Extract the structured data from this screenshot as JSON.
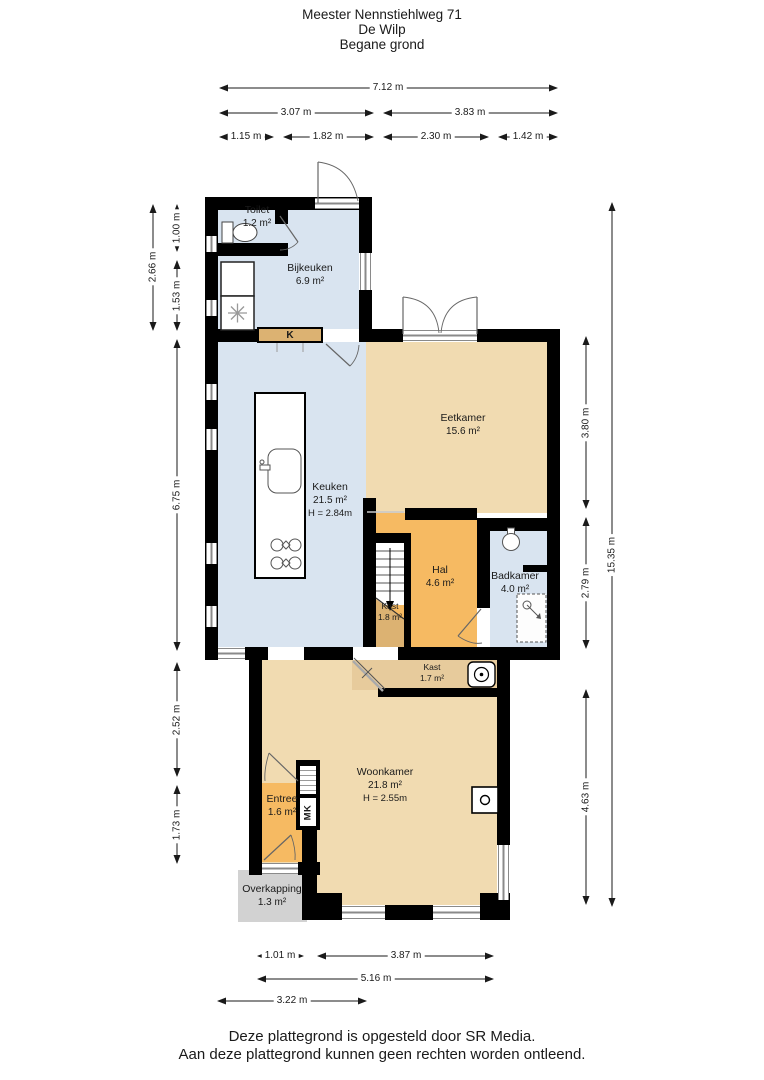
{
  "title": {
    "line1": "Meester Nennstiehlweg 71",
    "line2": "De Wilp",
    "line3": "Begane grond"
  },
  "rooms": {
    "toilet": {
      "name": "Toilet",
      "area": "1.2 m²"
    },
    "bijkeuken": {
      "name": "Bijkeuken",
      "area": "6.9 m²"
    },
    "eetkamer": {
      "name": "Eetkamer",
      "area": "15.6 m²"
    },
    "keuken": {
      "name": "Keuken",
      "area": "21.5 m²",
      "height": "H = 2.84m"
    },
    "hal": {
      "name": "Hal",
      "area": "4.6 m²"
    },
    "badkamer": {
      "name": "Badkamer",
      "area": "4.0 m²"
    },
    "kast_onder_trap": {
      "name": "Kast",
      "area": "1.8 m²"
    },
    "kast": {
      "name": "Kast",
      "area": "1.7 m²"
    },
    "woonkamer": {
      "name": "Woonkamer",
      "area": "21.8 m²",
      "height": "H = 2.55m"
    },
    "entree": {
      "name": "Entree",
      "area": "1.6 m²"
    },
    "overkapping": {
      "name": "Overkapping",
      "area": "1.3 m²"
    },
    "keukenkast_label": "K",
    "meterkast_label": "MK"
  },
  "dimensions": {
    "top": [
      "7.12 m",
      "3.07 m",
      "3.83 m",
      "1.15 m",
      "1.82 m",
      "2.30 m",
      "1.42 m"
    ],
    "left": [
      "2.66 m",
      "1.00 m",
      "1.53 m",
      "6.75 m",
      "2.52 m",
      "1.73 m"
    ],
    "right": [
      "15.35 m",
      "3.80 m",
      "2.79 m",
      "4.63 m"
    ],
    "bottom": [
      "1.01 m",
      "3.87 m",
      "5.16 m",
      "3.22 m"
    ]
  },
  "footer": {
    "line1": "Deze plattegrond is opgesteld door SR Media.",
    "line2": "Aan deze plattegrond kunnen geen rechten worden ontleend."
  },
  "colors": {
    "wet_room": "#d9e4f0",
    "living": "#f1dbb1",
    "hall": "#f6ba62",
    "closet": "#dcb272",
    "closet_light": "#e7cb9c",
    "outside_covered": "#d2d2d2",
    "wall": "#000000"
  }
}
